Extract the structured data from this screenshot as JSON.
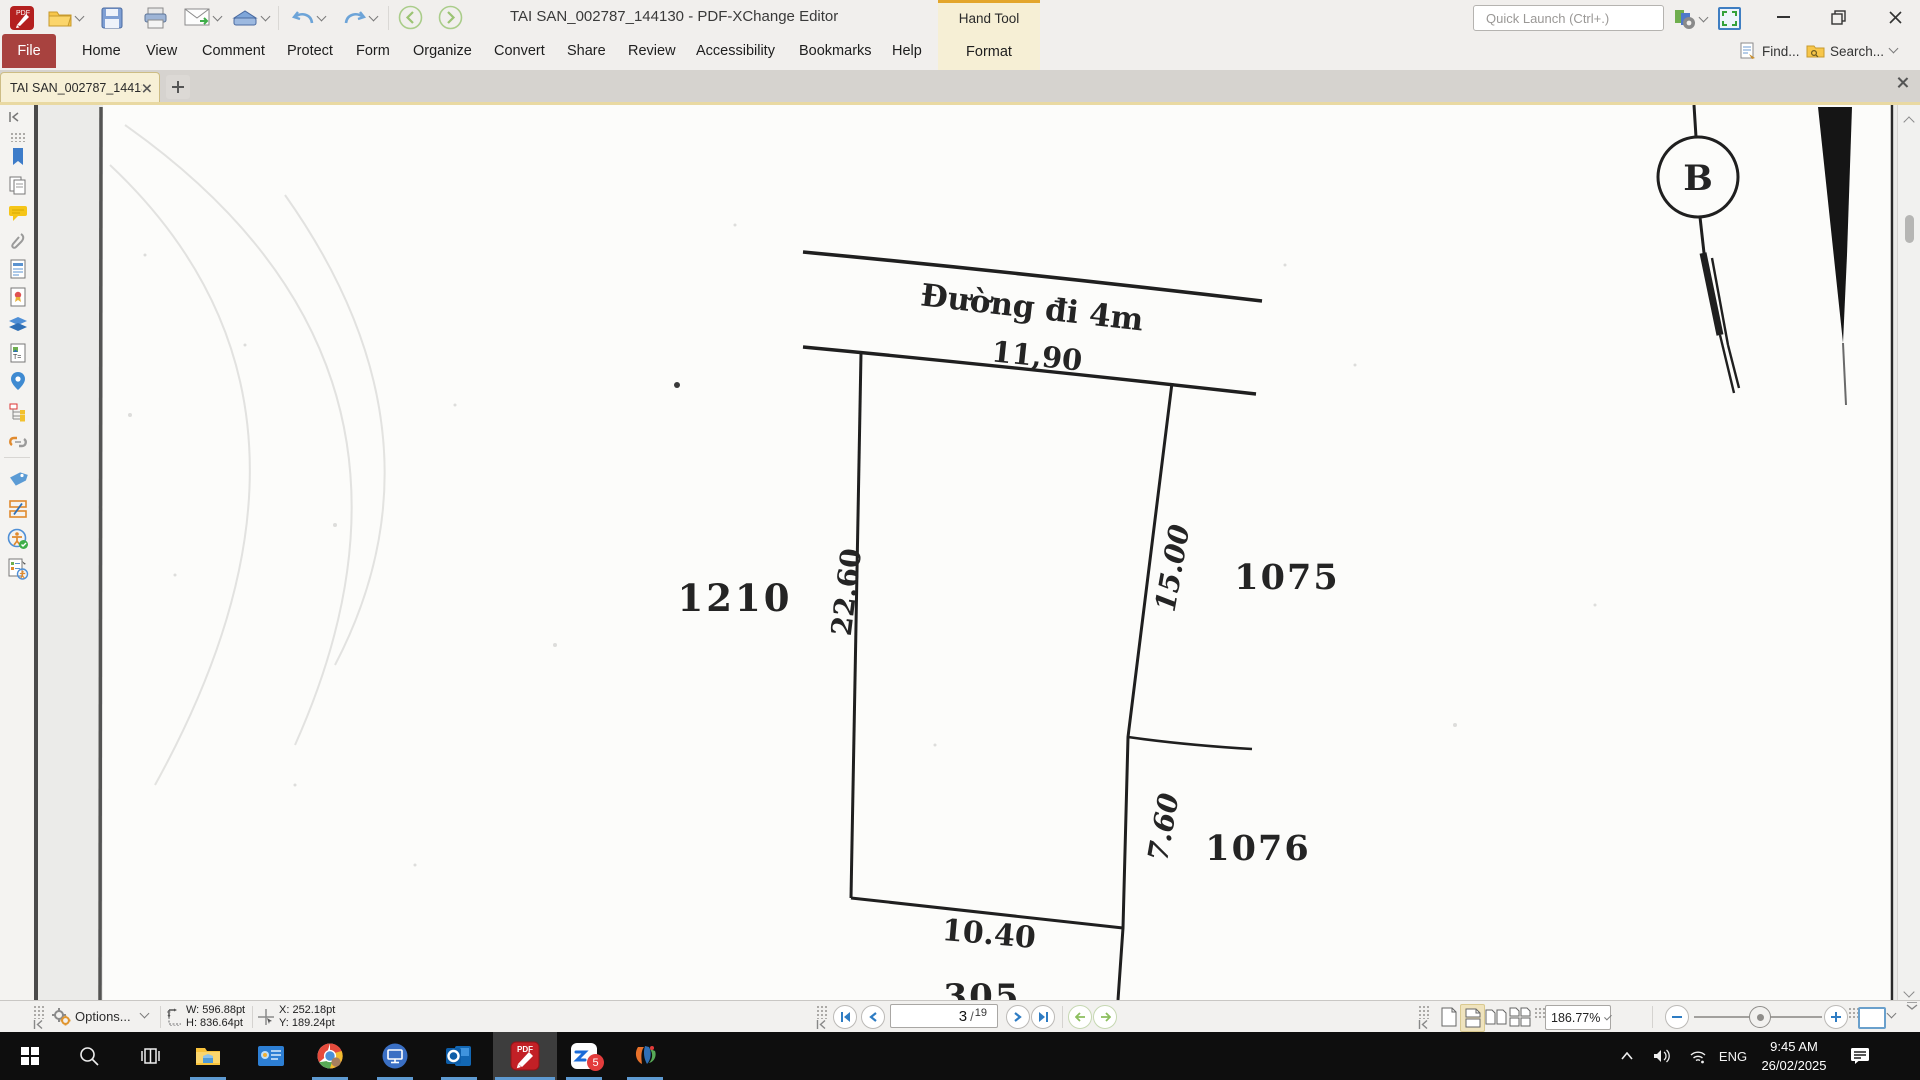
{
  "window": {
    "title": "TAI SAN_002787_144130 - PDF-XChange Editor",
    "quick_launch_placeholder": "Quick Launch (Ctrl+.)",
    "find_label": "Find...",
    "search_label": "Search..."
  },
  "ribbon": {
    "hand_tool_label": "Hand Tool",
    "format_label": "Format",
    "menu_items": [
      "File",
      "Home",
      "View",
      "Comment",
      "Protect",
      "Form",
      "Organize",
      "Convert",
      "Share",
      "Review",
      "Accessibility",
      "Bookmarks",
      "Help"
    ]
  },
  "tab_bar": {
    "active_tab": "TAI SAN_002787_144130"
  },
  "drawing": {
    "road_label": "Đường đi 4m",
    "dim_road_frontage": "11,90",
    "dim_left_side": "22.60",
    "dim_right_upper": "15.00",
    "dim_right_lower": "7.60",
    "dim_bottom": "10.40",
    "parcel_left": "1210",
    "parcel_right_upper": "1075",
    "parcel_right_lower": "1076",
    "parcel_bottom": "305",
    "marker_label": "B"
  },
  "status_bar": {
    "options_label": "Options...",
    "width_value": "W: 596.88pt",
    "height_value": "H: 836.64pt",
    "x_value": "X: 252.18pt",
    "y_value": "Y: 189.24pt",
    "page_current": "3",
    "page_separator": "/",
    "page_total": "19",
    "zoom_value": "186.77%"
  },
  "taskbar": {
    "pdf_icon_label": "PDF",
    "zalo_badge": "5",
    "language": "ENG",
    "time": "9:45 AM",
    "date": "26/02/2025"
  },
  "colors": {
    "accent_red_file": "#a8423f",
    "hand_tool_beige": "#f6efd5",
    "active_tab": "#f7f0d6",
    "nav_blue": "#2e7cc3",
    "nav_green": "#8cbf5e",
    "taskbar_underline": "#5e9ad1"
  }
}
